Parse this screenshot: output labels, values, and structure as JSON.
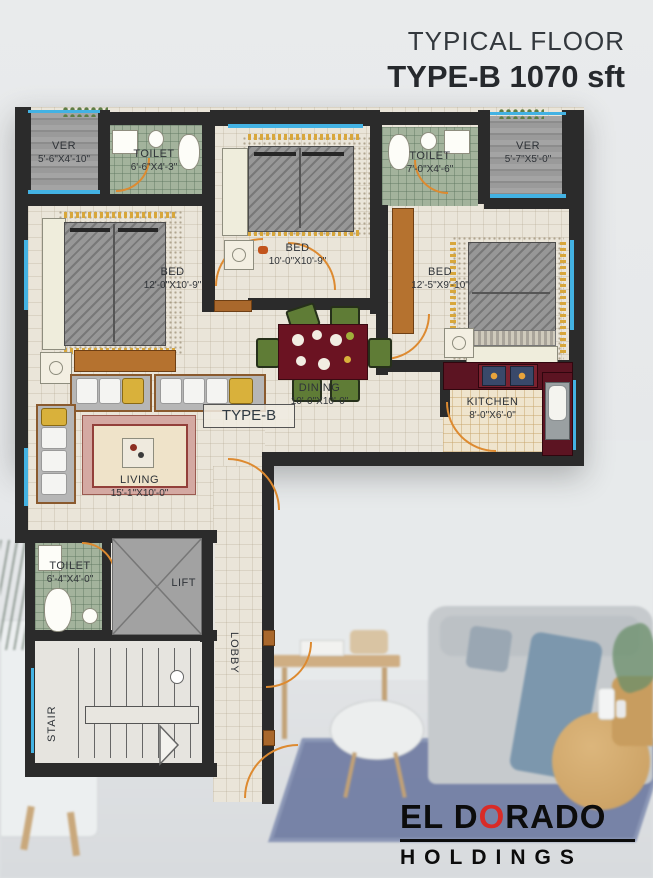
{
  "header": {
    "line1": "TYPICAL FLOOR",
    "line2": "TYPE-B 1070 sft"
  },
  "plan": {
    "unit_tag": "TYPE-B",
    "rooms": {
      "ver_left": {
        "name": "VER",
        "dims": "5'-6\"X4'-10\""
      },
      "toilet_top_left": {
        "name": "TOILET",
        "dims": "6'-6\"X4'-3\""
      },
      "bed_middle": {
        "name": "BED",
        "dims": "10'-0\"X10'-9\""
      },
      "toilet_top_right": {
        "name": "TOILET",
        "dims": "7'-0\"X4'-6\""
      },
      "ver_right": {
        "name": "VER",
        "dims": "5'-7\"X5'-0\""
      },
      "bed_left": {
        "name": "BED",
        "dims": "12'-0\"X10'-9\""
      },
      "bed_right": {
        "name": "BED",
        "dims": "12'-5\"X9'-10\""
      },
      "dining": {
        "name": "DINING",
        "dims": "10'-0\"X10'-0\""
      },
      "kitchen": {
        "name": "KITCHEN",
        "dims": "8'-0\"X6'-0\""
      },
      "living": {
        "name": "LIVING",
        "dims": "15'-1\"X10'-0\""
      },
      "toilet_bottom": {
        "name": "TOILET",
        "dims": "6'-4\"X4'-0\""
      },
      "lift": {
        "name": "LIFT"
      },
      "stair": {
        "name": "STAIR"
      },
      "lobby": {
        "name": "LOBBY"
      }
    }
  },
  "logo": {
    "word1_pre": "EL D",
    "word1_accent": "O",
    "word1_post": "RADO",
    "word2": "HOLDINGS"
  },
  "colors": {
    "wall": "#2b2b2b",
    "window": "#43b2e3",
    "door": "#dd8a30",
    "floor": "#eae5d9",
    "toilet_tile": "#a3b39c",
    "veranda": "#9a9a9a",
    "counter": "#5c1422",
    "chair": "#5f7c36",
    "logo_accent": "#d92b27",
    "title_text": "#33383d"
  }
}
